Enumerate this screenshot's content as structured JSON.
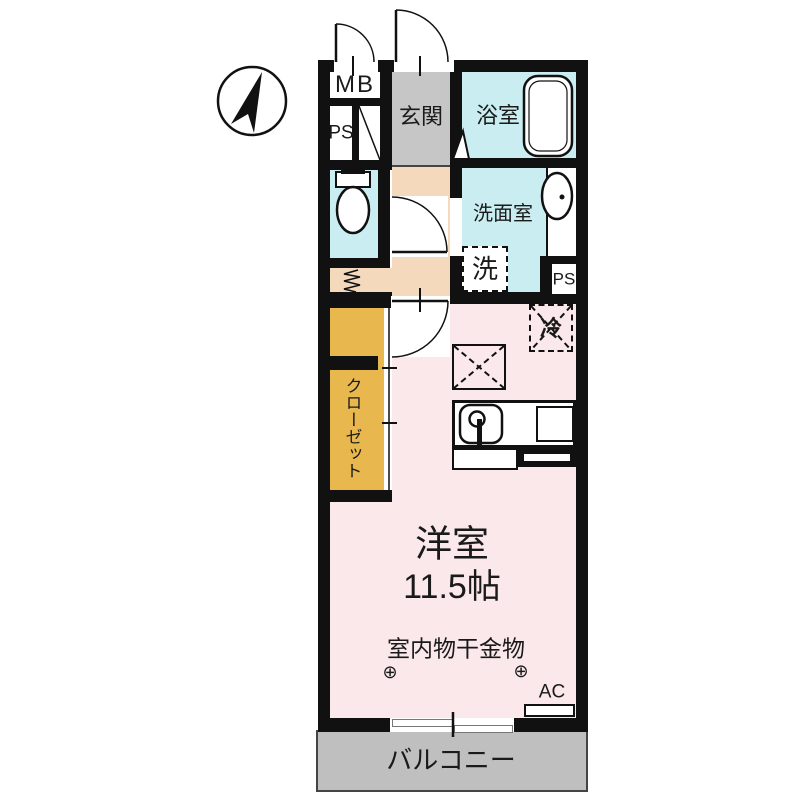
{
  "plan": {
    "type": "japanese-apartment-floorplan",
    "compass": "north-arrow-icon",
    "rooms": {
      "meter_box": "MB",
      "pipe_space_top": "PS",
      "entrance": "玄関",
      "bathroom": "浴室",
      "washroom": "洗面室",
      "washing_machine": "洗",
      "pipe_space_right": "PS",
      "closet": "クローゼット",
      "refrigerator": "冷",
      "main_room_name": "洋室",
      "main_room_size": "11.5帖",
      "laundry_hardware": "室内物干金物",
      "laundry_anchor_left": "⊕",
      "laundry_anchor_right": "⊕",
      "air_conditioner": "AC",
      "balcony": "バルコニー"
    },
    "colors": {
      "wall": "#111111",
      "wet_area": "#c9edf0",
      "entrance_floor": "#c6c6c6",
      "hallway_floor": "#f4d9bc",
      "closet_floor": "#e8b84e",
      "room_floor": "#fae8ea",
      "balcony_floor": "#bfbfbf"
    }
  }
}
